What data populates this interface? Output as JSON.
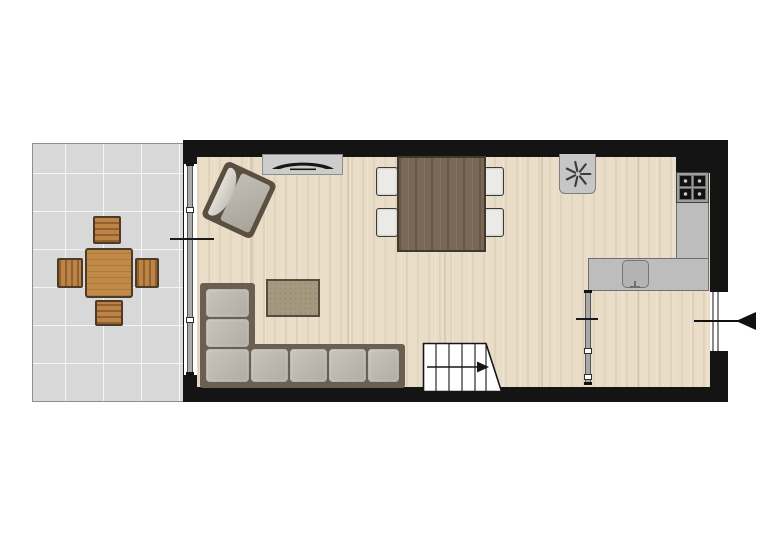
{
  "meta": {
    "type": "architectural floor plan",
    "view": "top-down 2D plan",
    "visible_text": ""
  },
  "colors": {
    "wall": "#141414",
    "wood_floor": "#e9ddc7",
    "patio_tile": "#d8d8d8",
    "kitchen_counter": "#bdbdbd",
    "cabinet": "#cdcdcd",
    "sofa_frame": "#6b5f52",
    "sofa_cushion": "#bcb8b0",
    "dining_table_wood": "#796856",
    "outdoor_furniture_wood": "#bd8344",
    "rug": "#a5987f",
    "glass_track": "#8f8f8f",
    "stairs_fill": "#ffffff",
    "marker_line": "#1a1a1a",
    "background": "#ffffff"
  },
  "rooms": {
    "patio": {
      "label": "Patio / terrace with concrete tiles"
    },
    "living_kitchen": {
      "label": "Living room with open kitchen, wood floor"
    },
    "hall": {
      "label": "Entrance hall, wood floor"
    }
  },
  "furniture": {
    "outdoor_table": {
      "label": "Outdoor dining table"
    },
    "outdoor_chair_north": {
      "label": "Outdoor chair (north)"
    },
    "outdoor_chair_south": {
      "label": "Outdoor chair (south)"
    },
    "outdoor_chair_west": {
      "label": "Outdoor chair (west)"
    },
    "outdoor_chair_east": {
      "label": "Outdoor chair (east)"
    },
    "tv_cabinet": {
      "label": "TV cabinet with flat-screen television"
    },
    "armchair": {
      "label": "Armchair, angled toward room"
    },
    "rug": {
      "label": "Rug"
    },
    "sofa": {
      "label": "L-shaped corner sofa",
      "seat_cushions": 7
    },
    "dining_table": {
      "label": "Dining table, dark wood"
    },
    "dining_chair": {
      "label": "Dining chair",
      "count": 4
    },
    "kitchen_counter": {
      "label": "L-shaped kitchen counter"
    },
    "cooktop": {
      "label": "4-burner cooktop",
      "burners": 4
    },
    "sink": {
      "label": "Kitchen sink with faucet"
    }
  },
  "symbols": {
    "extractor_fan": {
      "label": "Mechanical ventilation / extractor point"
    },
    "patio_door": {
      "label": "Sliding glass patio door"
    },
    "interior_partition": {
      "label": "Glass partition between living room and hall"
    },
    "entrance_door": {
      "label": "Front entrance door"
    },
    "entrance_arrow": {
      "label": "Entrance direction arrow"
    },
    "staircase": {
      "label": "Staircase going up",
      "treads": 6
    }
  }
}
